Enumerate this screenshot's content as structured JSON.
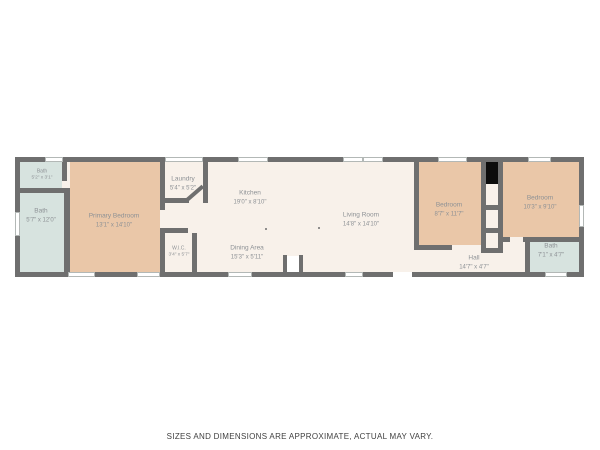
{
  "footer": {
    "disclaimer": "SIZES AND DIMENSIONS ARE APPROXIMATE, ACTUAL MAY VARY."
  },
  "rooms": {
    "bath_small": {
      "name": "Bath",
      "dims": "5'2\" x 3'1\""
    },
    "bath_left": {
      "name": "Bath",
      "dims": "5'7\" x 12'0\""
    },
    "primary_bedroom": {
      "name": "Primary Bedroom",
      "dims": "13'1\" x 14'10\""
    },
    "laundry": {
      "name": "Laundry",
      "dims": "5'4\" x 5'2\""
    },
    "kitchen": {
      "name": "Kitchen",
      "dims": "19'0\" x 8'10\""
    },
    "wic": {
      "name": "W.I.C.",
      "dims": "3'4\" x 5'7\""
    },
    "dining": {
      "name": "Dining Area",
      "dims": "15'3\" x 5'11\""
    },
    "living": {
      "name": "Living Room",
      "dims": "14'8\" x 14'10\""
    },
    "bedroom_mid": {
      "name": "Bedroom",
      "dims": "8'7\" x 11'7\""
    },
    "bedroom_right": {
      "name": "Bedroom",
      "dims": "10'3\" x 9'10\""
    },
    "hall": {
      "name": "Hall",
      "dims": "14'7\" x 4'7\""
    },
    "bath_right": {
      "name": "Bath",
      "dims": "7'1\" x 4'7\""
    }
  },
  "colors": {
    "wall": "#6f6f6f",
    "floor": "#f8f1ea",
    "bedroom_fill": "#eac7a8",
    "bath_fill": "#d7e3df",
    "utility_black": "#0c0c0c",
    "label_text": "#8d9195",
    "disclaimer_text": "#3f3f3f"
  }
}
